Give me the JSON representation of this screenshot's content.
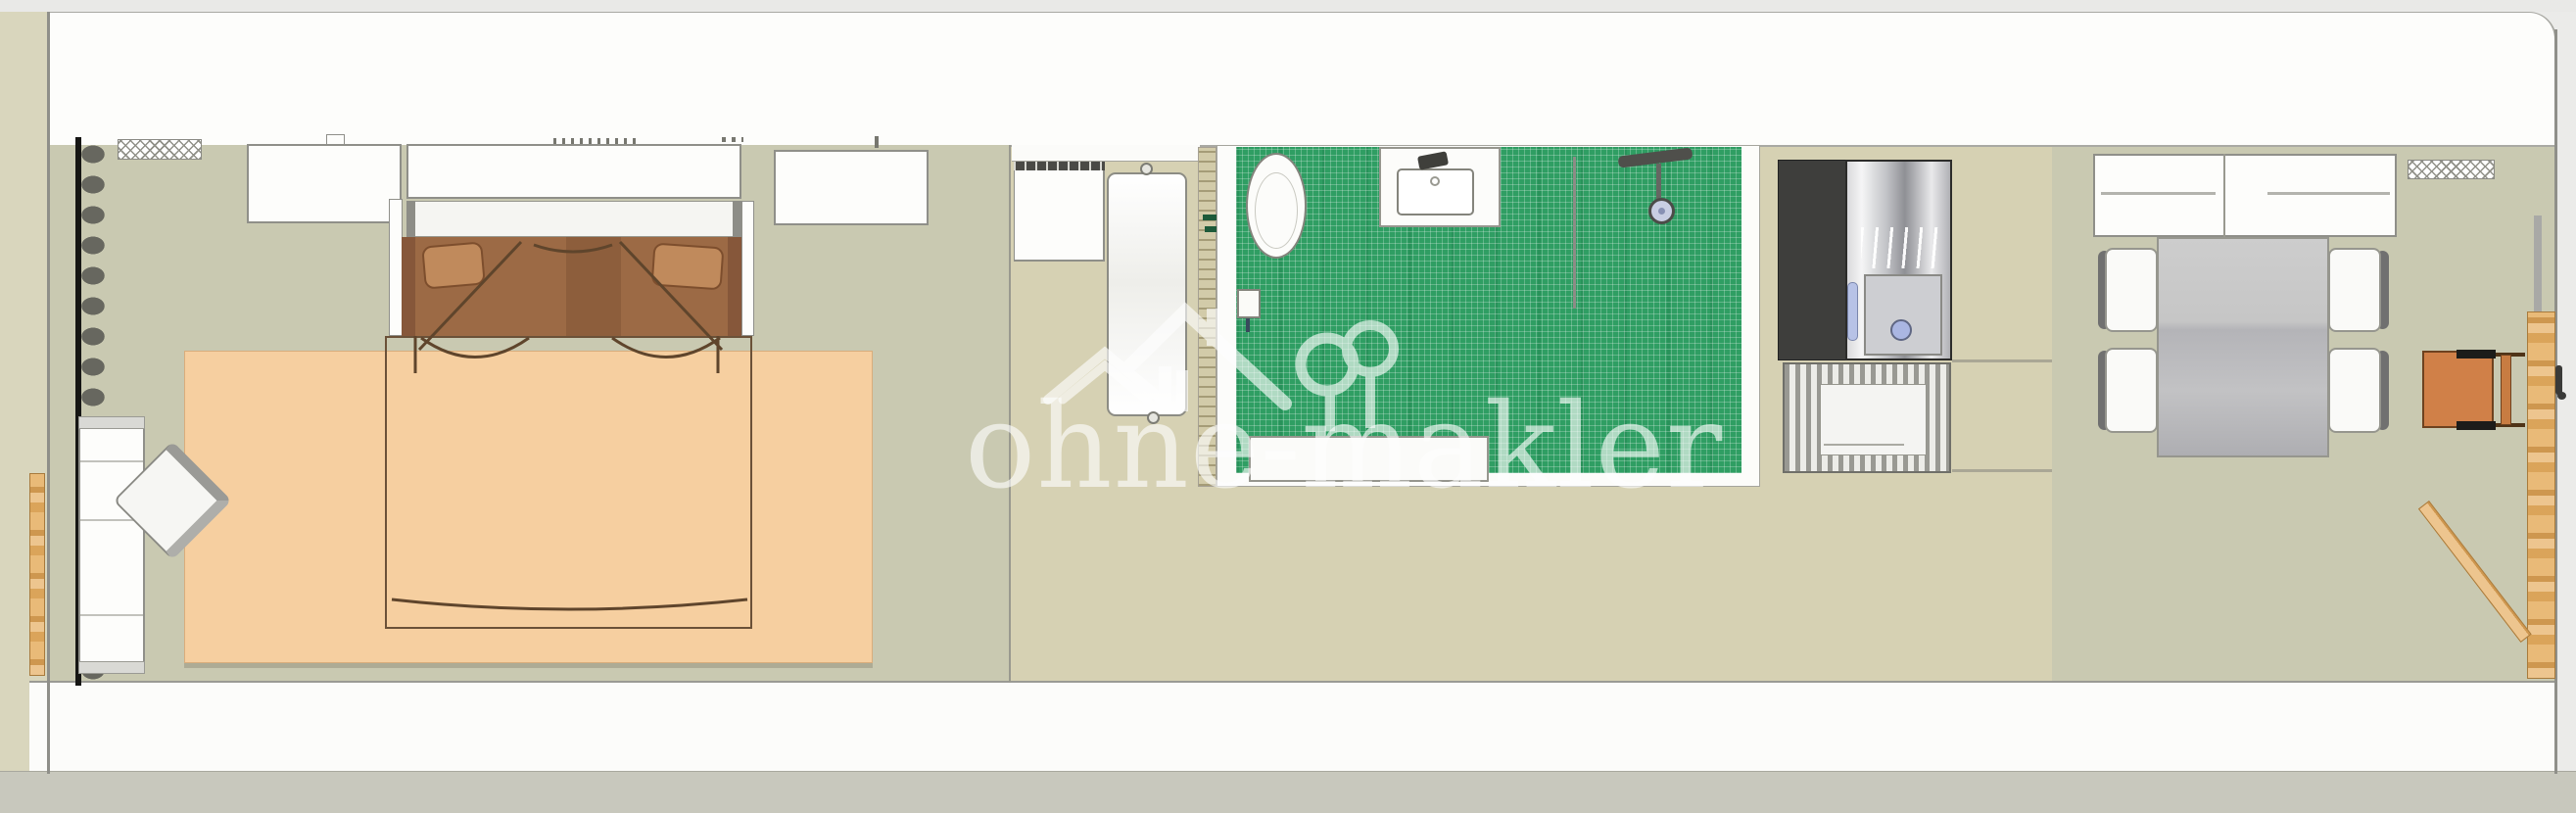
{
  "title": "apartment-floor-plan",
  "watermark": {
    "text": "ohne-makler",
    "logo": "house-and-tree"
  },
  "palette": {
    "bathroom_tile_green": "#2f9e63",
    "bedroom_floor": "#c9c9b1",
    "hall_floor": "#d6d1b3",
    "living_floor": "#c9c9b1",
    "rug_peach": "#f6cfa0",
    "bed_brown": "#9c6a45",
    "bed_pillow_brown": "#c08a5c",
    "wood_door": "#e7b269",
    "chair_orange": "#d08048",
    "wall_white": "#fdfdfb",
    "stone_gray": "#67675f",
    "appliance_steel": "#b9babe",
    "accent_blue": "#aab6e2"
  },
  "rooms": {
    "bedroom": [
      "radiator",
      "wardrobe",
      "double-bed",
      "rug",
      "desk",
      "desk-chair",
      "stone-wall"
    ],
    "bathroom": [
      "toilet",
      "toilet-paper-holder",
      "sink",
      "shower",
      "glass-partition",
      "bathtub",
      "washing-machine",
      "door"
    ],
    "kitchen": [
      "boiler-unit",
      "striped-mat"
    ],
    "dining": [
      "sideboard",
      "radiator",
      "dining-table",
      "four-chairs",
      "high-chair",
      "open-door"
    ]
  }
}
